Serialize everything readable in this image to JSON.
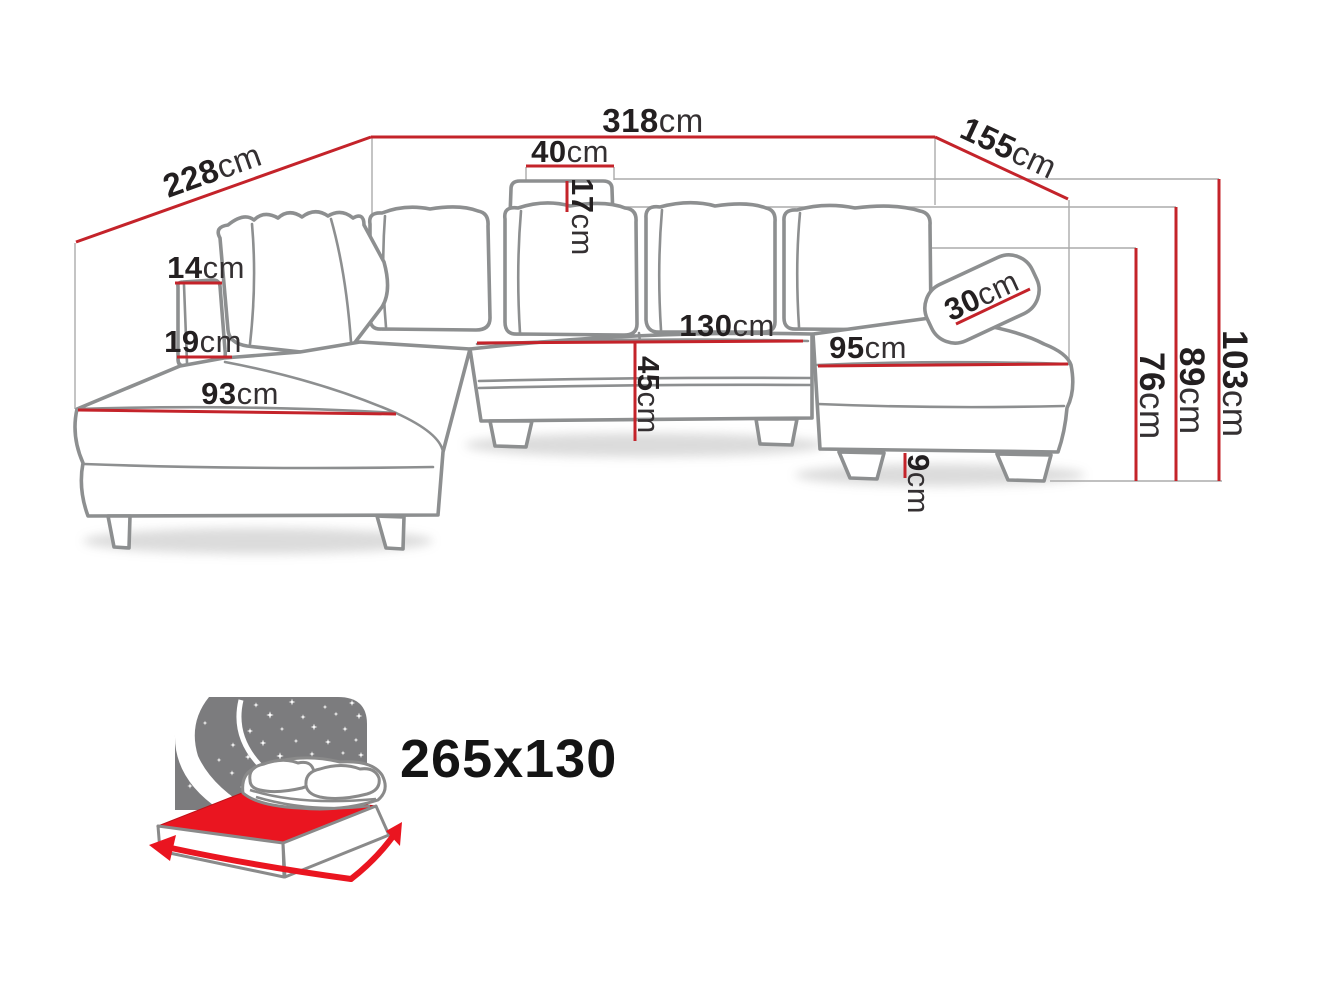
{
  "diagram_title": "corner-sofa-dimension-diagram",
  "colors": {
    "dimension_line": "#c4232a",
    "sofa_outline": "#8d8f90",
    "icon_gray": "#7c7c7e",
    "icon_red": "#ea1520"
  },
  "dims": {
    "d318": {
      "value": "318",
      "unit": "cm"
    },
    "d228": {
      "value": "228",
      "unit": "cm"
    },
    "d155": {
      "value": "155",
      "unit": "cm"
    },
    "d40": {
      "value": "40",
      "unit": "cm"
    },
    "d17": {
      "value": "17",
      "unit": "cm"
    },
    "d14": {
      "value": "14",
      "unit": "cm"
    },
    "d19": {
      "value": "19",
      "unit": "cm"
    },
    "d93": {
      "value": "93",
      "unit": "cm"
    },
    "d130": {
      "value": "130",
      "unit": "cm"
    },
    "d45": {
      "value": "45",
      "unit": "cm"
    },
    "d95": {
      "value": "95",
      "unit": "cm"
    },
    "d30": {
      "value": "30",
      "unit": "cm"
    },
    "d76": {
      "value": "76",
      "unit": "cm"
    },
    "d89": {
      "value": "89",
      "unit": "cm"
    },
    "d103": {
      "value": "103",
      "unit": "cm"
    },
    "d9": {
      "value": "9",
      "unit": "cm"
    }
  },
  "sleeping": {
    "size": "265x130"
  }
}
